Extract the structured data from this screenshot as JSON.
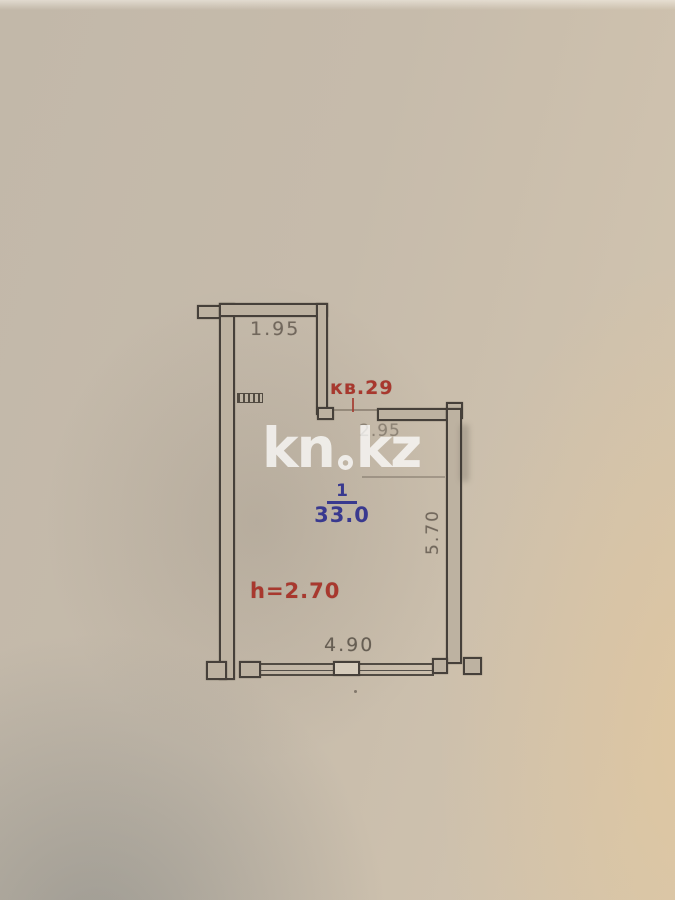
{
  "watermark": {
    "part1": "kn",
    "part2": "kz",
    "dot_icon": "pin-dot-icon",
    "full_text": "kn.kz"
  },
  "plan": {
    "apartment_label": "кв.29",
    "room": {
      "number": "1",
      "area": "33.0"
    },
    "ceiling_height": "h=2.70",
    "dimensions": {
      "top_width": "1.95",
      "entry_width": "2.95",
      "right_height": "5.70",
      "bottom_width": "4.90"
    },
    "colors": {
      "label_red": "#a8382e",
      "label_blue": "#39398f",
      "dimension_text": "#6b6156",
      "wall_line": "#46403a",
      "paper": "#c5baaa",
      "watermark_white": "rgba(255,255,255,0.74)"
    }
  }
}
